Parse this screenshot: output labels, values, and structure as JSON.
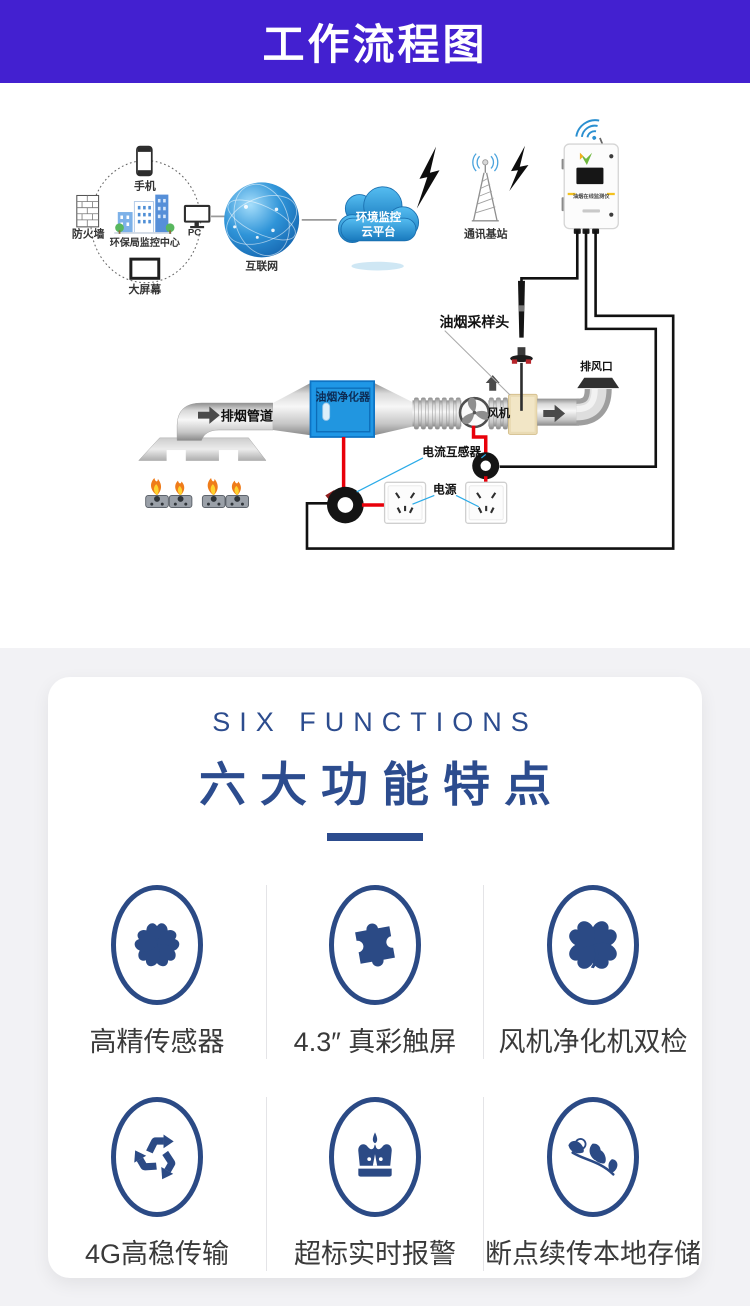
{
  "header": {
    "title": "工作流程图",
    "bg": "#4320d0"
  },
  "diagram": {
    "labels": {
      "phone": "手机",
      "firewall": "防火墙",
      "center": "环保局监控中心",
      "pc": "PC",
      "screen": "大屏幕",
      "internet": "互联网",
      "cloud_line1": "环境监控",
      "cloud_line2": "云平台",
      "station": "通讯基站",
      "device": "油烟在线监测仪",
      "probe": "油烟采样头",
      "vent": "排风口",
      "fan": "风机",
      "pipe": "排烟管道",
      "purifier": "油烟净化器",
      "transformer": "电流互感器",
      "power": "电源"
    }
  },
  "functions": {
    "title_en": "SIX  FUNCTIONS",
    "title_zh": "六大功能特点",
    "accent": "#2c4c8e",
    "icon_navy": "#2b4a85",
    "items": [
      {
        "icon": "flower-icon",
        "label": "高精传感器"
      },
      {
        "icon": "puzzle-icon",
        "label": "4.3″ 真彩触屏"
      },
      {
        "icon": "clover-icon",
        "label": "风机净化机双检"
      },
      {
        "icon": "recycle-icon",
        "label": "4G高稳传输"
      },
      {
        "icon": "crown-icon",
        "label": "超标实时报警"
      },
      {
        "icon": "leaf-icon",
        "label": "断点续传本地存储"
      }
    ]
  }
}
